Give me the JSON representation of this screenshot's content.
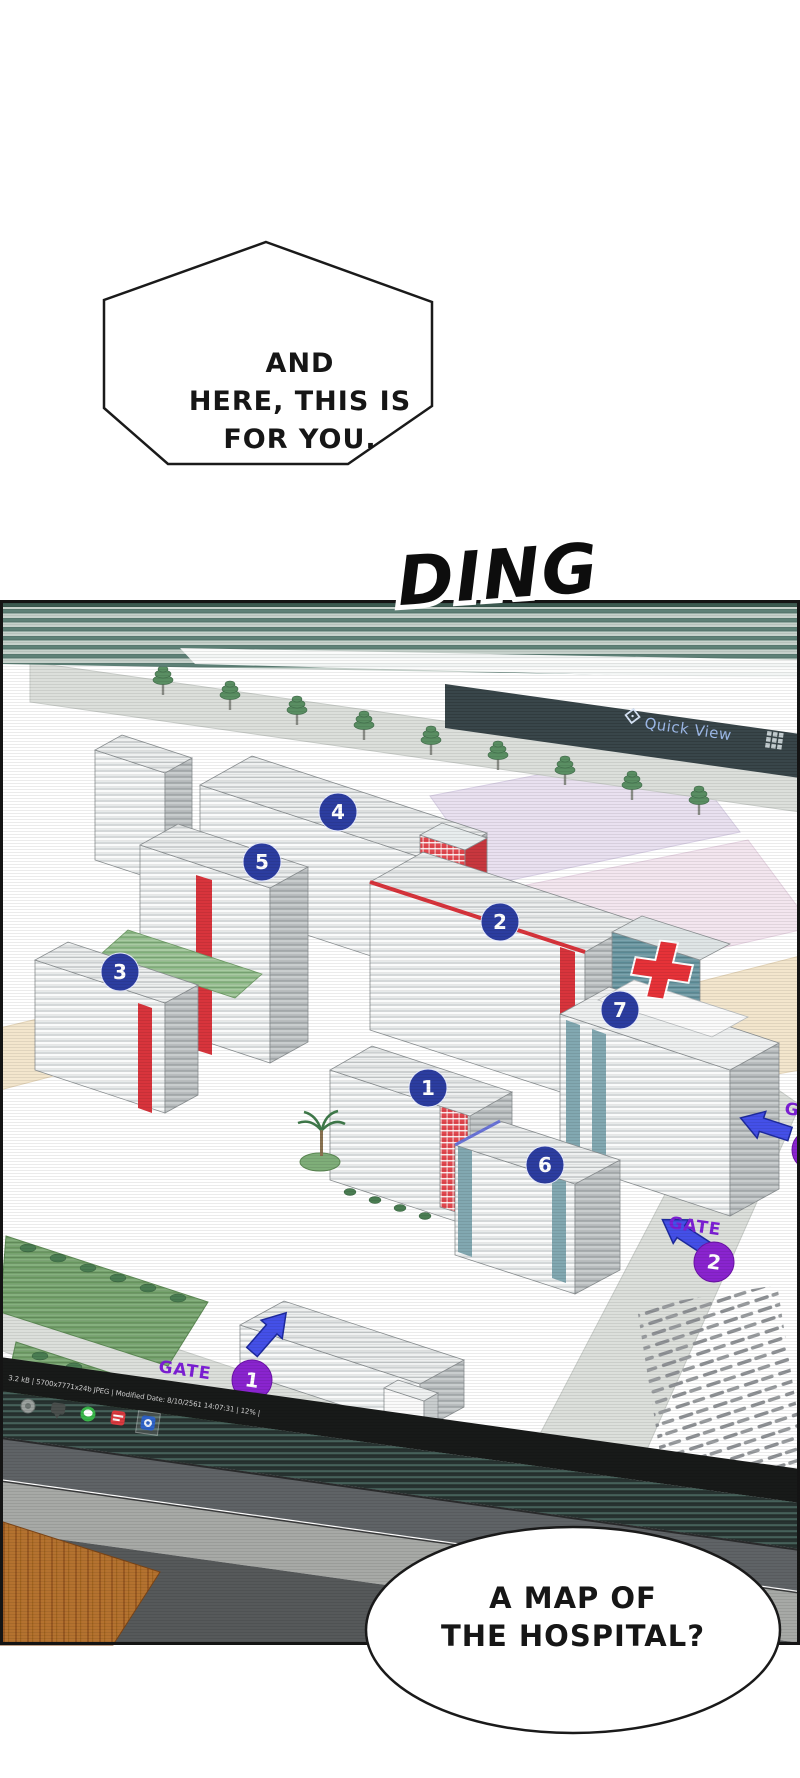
{
  "bubble_top": {
    "line1": "AND",
    "line2": "HERE, THIS IS",
    "line3": "FOR YOU."
  },
  "sfx": {
    "ding": "DING"
  },
  "viewer": {
    "quick_view_label": "Quick View",
    "status_text": "3.2 kB | 5700x7771x24b JPEG | Modified Date: 8/10/2561 14:07:31 | 12% |",
    "icons": {
      "quick_view": "diamond-lens-icon",
      "grid": "grid-3x3-icon",
      "taskbar": [
        "app-circle",
        "chat-bubble",
        "line-green-circle",
        "red-app",
        "settings-blue-highlighted"
      ]
    }
  },
  "map": {
    "badges": {
      "b1": "1",
      "b2": "2",
      "b3": "3",
      "b4": "4",
      "b5": "5",
      "b6": "6",
      "b7": "7"
    },
    "gates": {
      "g1_label": "GATE",
      "g1_num": "1",
      "g2_label": "GATE",
      "g2_num": "2",
      "g3_label": "GATE"
    }
  },
  "bubble_bottom": {
    "line1": "A MAP OF",
    "line2": "THE HOSPITAL?"
  },
  "colors": {
    "badge_blue": "#2c3da0",
    "gate_purple": "#8a24cf",
    "arrow_blue": "#4450e8",
    "accent_red": "#d8343c",
    "bezel_teal": "#5e8177",
    "hospital_teal": "#82a8b1",
    "quickview_text": "#9db9e8",
    "desk_wood": "#b4722f"
  }
}
